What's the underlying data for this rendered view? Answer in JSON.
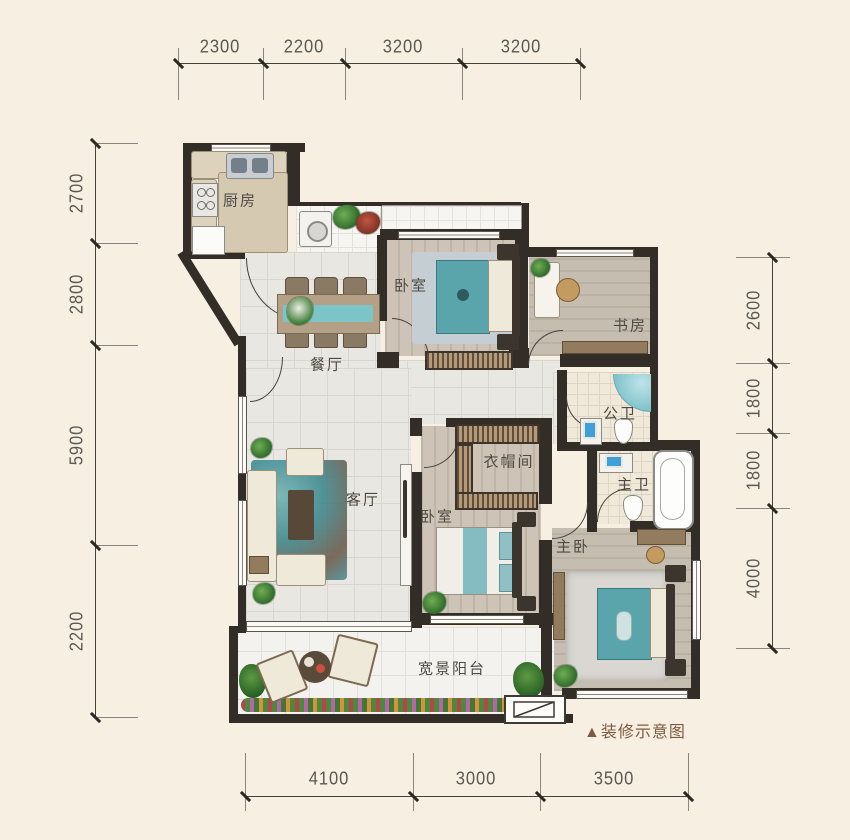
{
  "meta": {
    "caption": "▲装修示意图"
  },
  "rooms": {
    "kitchen": "厨房",
    "bedroom1": "卧室",
    "study": "书房",
    "dining": "餐厅",
    "guest_bath": "公卫",
    "cloakroom": "衣帽间",
    "master_bath": "主卫",
    "living": "客厅",
    "bedroom2": "卧室",
    "master_bedroom": "主卧",
    "balcony": "宽景阳台"
  },
  "dimensions": {
    "top": [
      "2300",
      "2200",
      "3200",
      "3200"
    ],
    "left": [
      "2700",
      "2800",
      "5900",
      "2200"
    ],
    "right": [
      "2600",
      "1800",
      "1800",
      "4000"
    ],
    "bottom": [
      "4100",
      "3000",
      "3500"
    ]
  },
  "colors": {
    "background": "#f7f0e2",
    "wall": "#332d27",
    "teal_accent": "#59a5ab",
    "caption_brown": "#7d5a40"
  }
}
